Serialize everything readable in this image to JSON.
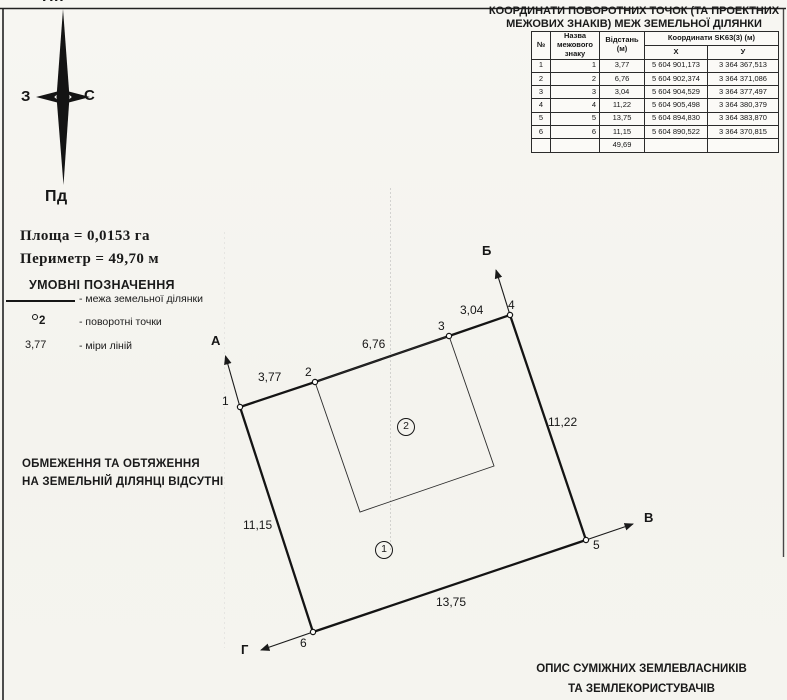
{
  "compass": {
    "north": "Пн",
    "south": "Пд",
    "west": "З",
    "east": "С"
  },
  "coord_table": {
    "title_lines": [
      "КООРДИНАТИ ПОВОРОТНИХ ТОЧОК (ТА ПРОЕКТНИХ",
      "МЕЖОВИХ ЗНАКІВ) МЕЖ ЗЕМЕЛЬНОЇ ДІЛЯНКИ"
    ],
    "columns": {
      "num": "№",
      "mark_name": "Назва межового знаку",
      "distance": "Відстань (м)",
      "coords_group": "Координати SK63(3) (м)",
      "x": "Х",
      "y": "У"
    },
    "rows": [
      {
        "num": "1",
        "name": "1",
        "dist": "3,77",
        "x": "5 604 901,173",
        "y": "3 364 367,513"
      },
      {
        "num": "2",
        "name": "2",
        "dist": "6,76",
        "x": "5 604 902,374",
        "y": "3 364 371,086"
      },
      {
        "num": "3",
        "name": "3",
        "dist": "3,04",
        "x": "5 604 904,529",
        "y": "3 364 377,497"
      },
      {
        "num": "4",
        "name": "4",
        "dist": "11,22",
        "x": "5 604 905,498",
        "y": "3 364 380,379"
      },
      {
        "num": "5",
        "name": "5",
        "dist": "13,75",
        "x": "5 604 894,830",
        "y": "3 364 383,870"
      },
      {
        "num": "6",
        "name": "6",
        "dist": "11,15",
        "x": "5 604 890,522",
        "y": "3 364 370,815"
      }
    ],
    "total_distance": "49,69"
  },
  "summary": {
    "area": "Площа = 0,0153 га",
    "perimeter": "Периметр = 49,70 м"
  },
  "legend": {
    "title": "УМОВНІ ПОЗНАЧЕННЯ",
    "boundary_label": "- межа земельної ділянки",
    "point_symbol": "2",
    "point_label": "- поворотні точки",
    "measure_symbol": "3,77",
    "measure_label": "- міри ліній"
  },
  "restrictions_lines": [
    "ОБМЕЖЕННЯ ТА ОБТЯЖЕННЯ",
    "НА ЗЕМЕЛЬНІЙ ДІЛЯНЦІ ВІДСУТНІ"
  ],
  "adjacent_lines": [
    "ОПИС СУМІЖНИХ ЗЕМЛЕВЛАСНИКІВ",
    "ТА ЗЕМЛЕКОРИСТУВАЧІВ"
  ],
  "plan": {
    "vertices": [
      "1",
      "2",
      "3",
      "4",
      "5",
      "6"
    ],
    "edges": [
      "3,77",
      "6,76",
      "3,04",
      "11,22",
      "13,75",
      "11,15"
    ],
    "directions": [
      "А",
      "Б",
      "В",
      "Г"
    ],
    "parcels": [
      "1",
      "2"
    ]
  },
  "colors": {
    "ink": "#1a1a1a",
    "paper": "#f5f4ef"
  }
}
